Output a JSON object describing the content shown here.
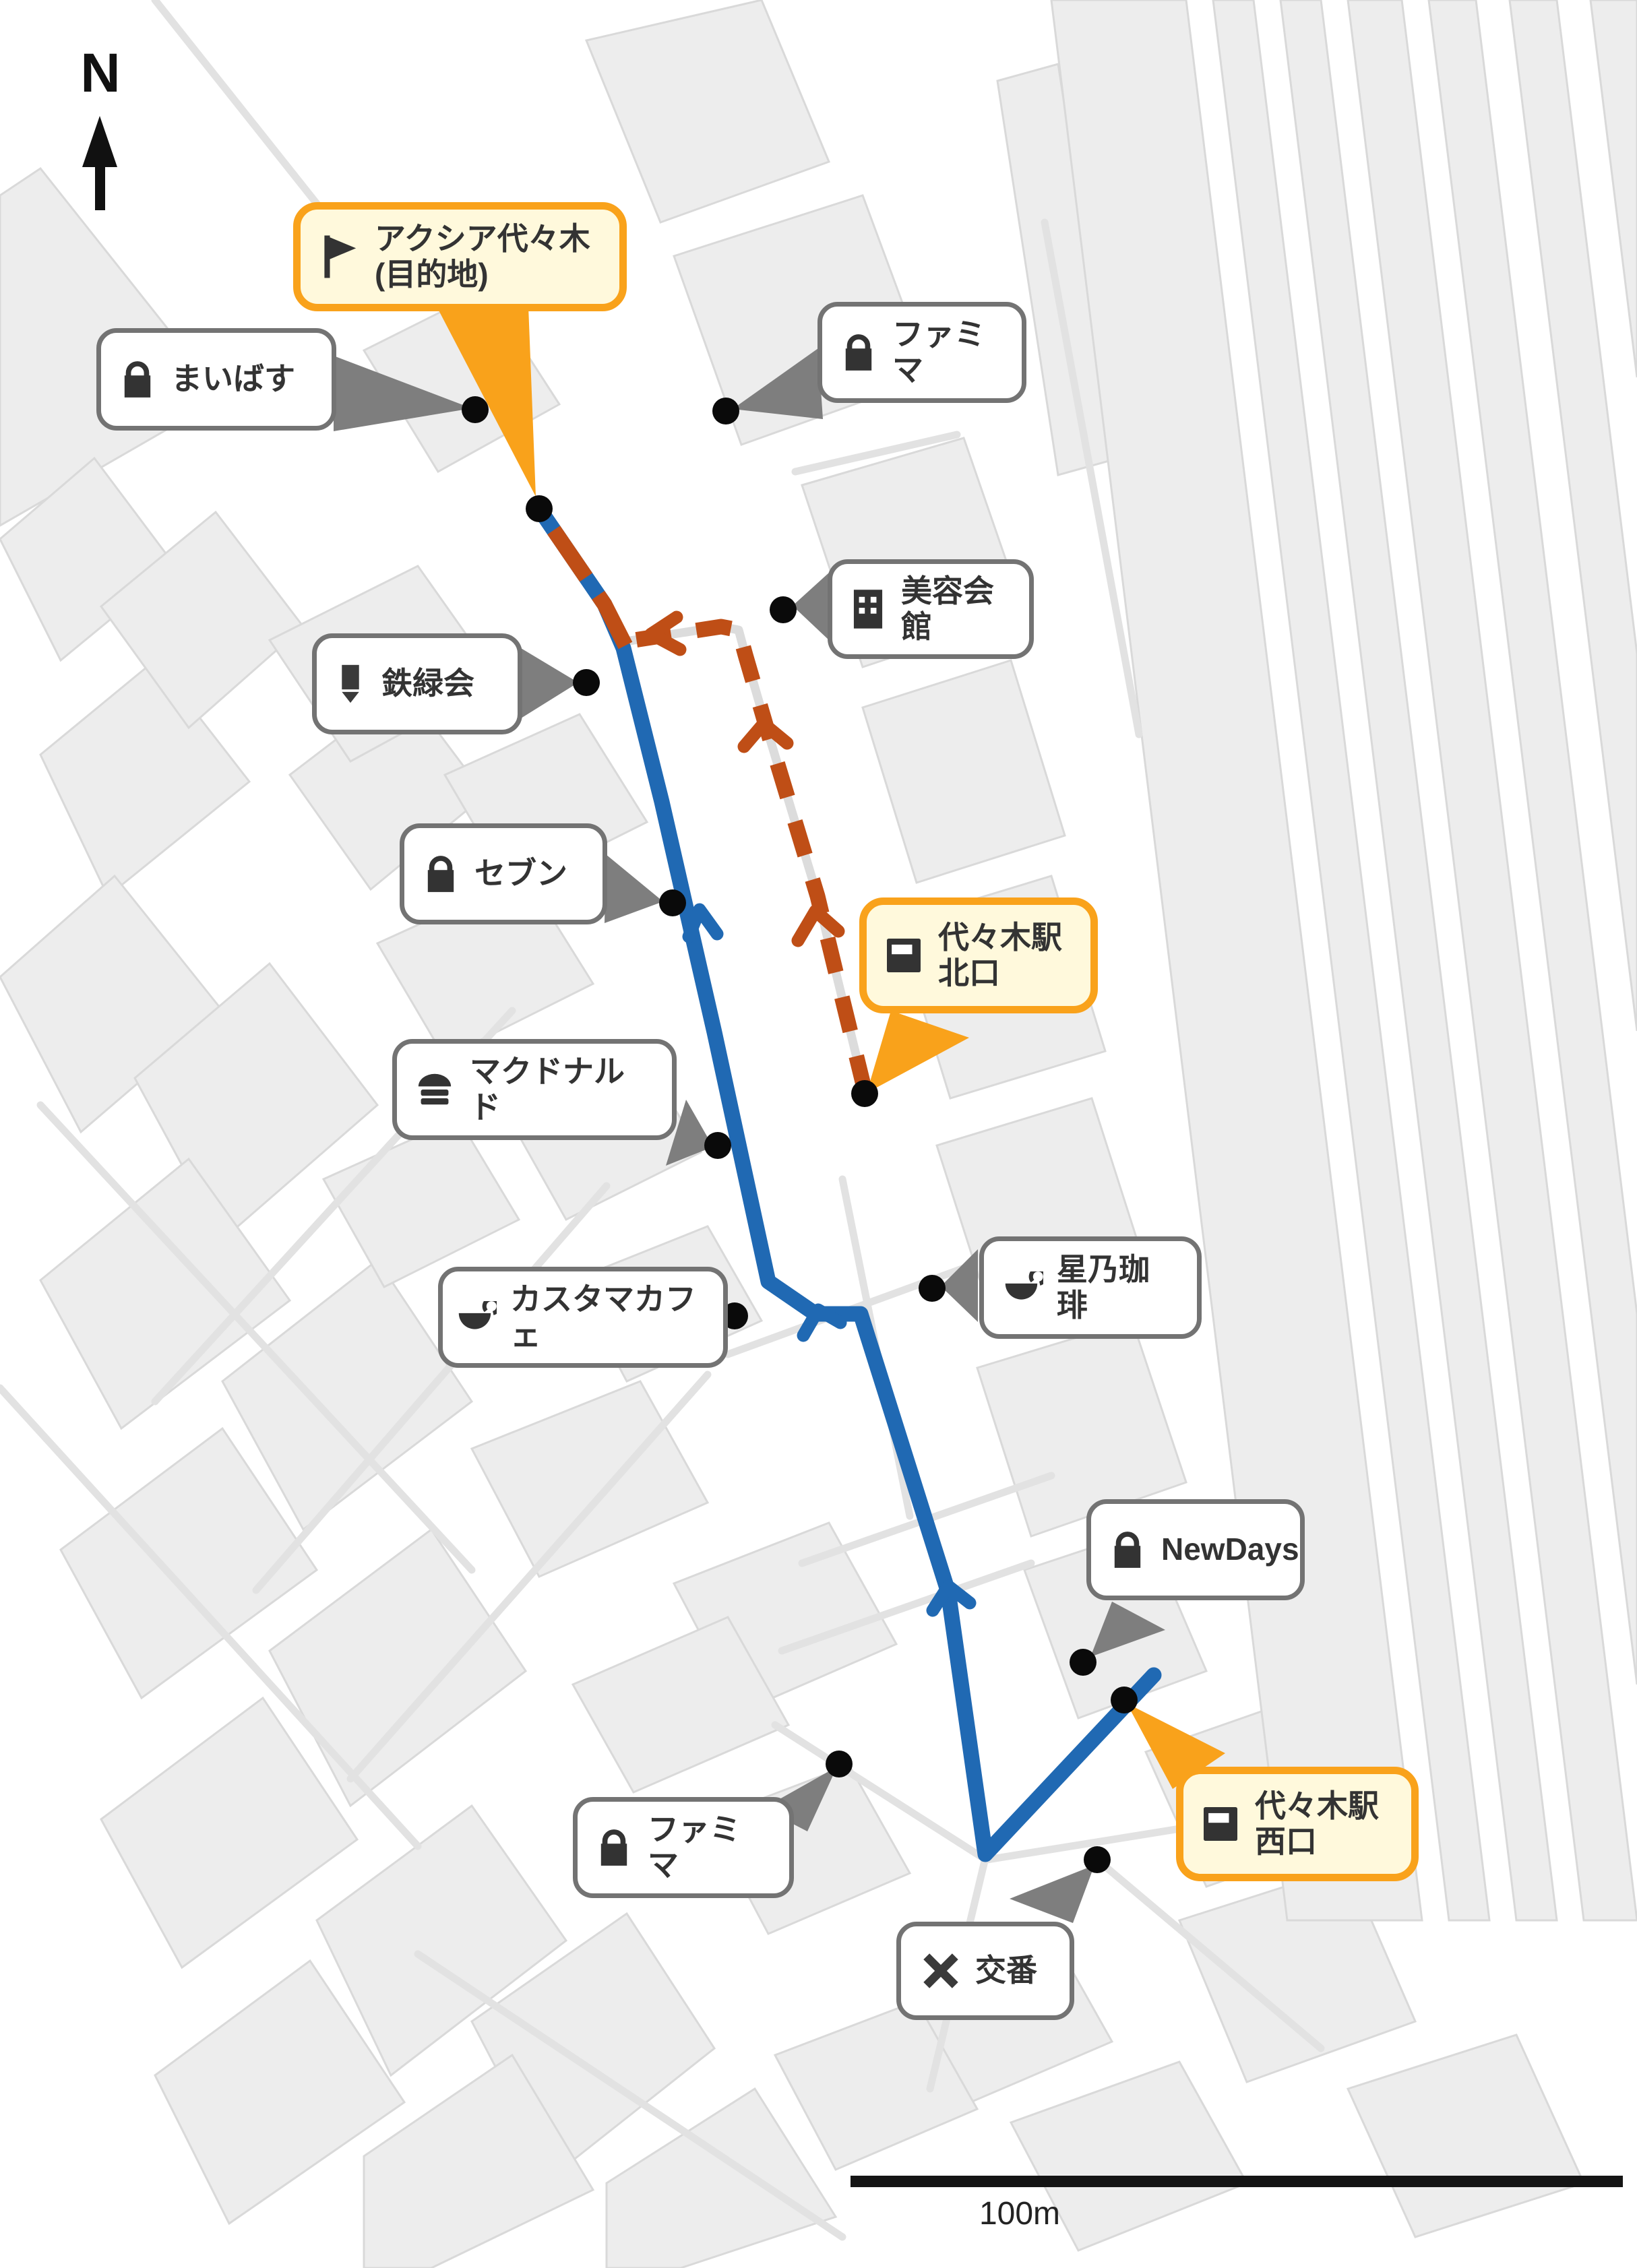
{
  "compass": {
    "label": "N"
  },
  "scale_bar": {
    "label": "100m"
  },
  "colors": {
    "route_walk_blue": "#2069B3",
    "route_alt_rust": "#BF4E16",
    "highlight_orange": "#F9A21B",
    "highlight_bg_yellow": "#FFF9DC",
    "pointer_gray": "#7E7E7E",
    "building_fill": "#EDEDED",
    "poi_dot_black": "#0A0A0A"
  },
  "labels": [
    {
      "id": "destination",
      "text": "アクシア代々木\n(目的地)",
      "icon": "flag-icon",
      "highlighted": true
    },
    {
      "id": "maibasu",
      "text": "まいばす",
      "icon": "shop-icon",
      "highlighted": false
    },
    {
      "id": "famima-north",
      "text": "ファミマ",
      "icon": "shop-icon",
      "highlighted": false
    },
    {
      "id": "biyo-kaikan",
      "text": "美容会館",
      "icon": "building-icon",
      "highlighted": false
    },
    {
      "id": "tetsuryokukai",
      "text": "鉄緑会",
      "icon": "pencil-icon",
      "highlighted": false
    },
    {
      "id": "seven",
      "text": "セブン",
      "icon": "shop-icon",
      "highlighted": false
    },
    {
      "id": "mcdonalds",
      "text": "マクドナルド",
      "icon": "burger-icon",
      "highlighted": false
    },
    {
      "id": "yoyogi-north-exit",
      "text": "代々木駅\n北口",
      "icon": "station-icon",
      "highlighted": true
    },
    {
      "id": "customa-cafe",
      "text": "カスタマカフェ",
      "icon": "coffee-icon",
      "highlighted": false
    },
    {
      "id": "hoshino-coffee",
      "text": "星乃珈琲",
      "icon": "coffee-icon",
      "highlighted": false
    },
    {
      "id": "newdays",
      "text": "NewDays",
      "icon": "shop-icon",
      "highlighted": false
    },
    {
      "id": "yoyogi-west-exit",
      "text": "代々木駅\n西口",
      "icon": "station-icon",
      "highlighted": true
    },
    {
      "id": "famima-south",
      "text": "ファミマ",
      "icon": "shop-icon",
      "highlighted": false
    },
    {
      "id": "koban",
      "text": "交番",
      "icon": "x-icon",
      "highlighted": false
    }
  ]
}
